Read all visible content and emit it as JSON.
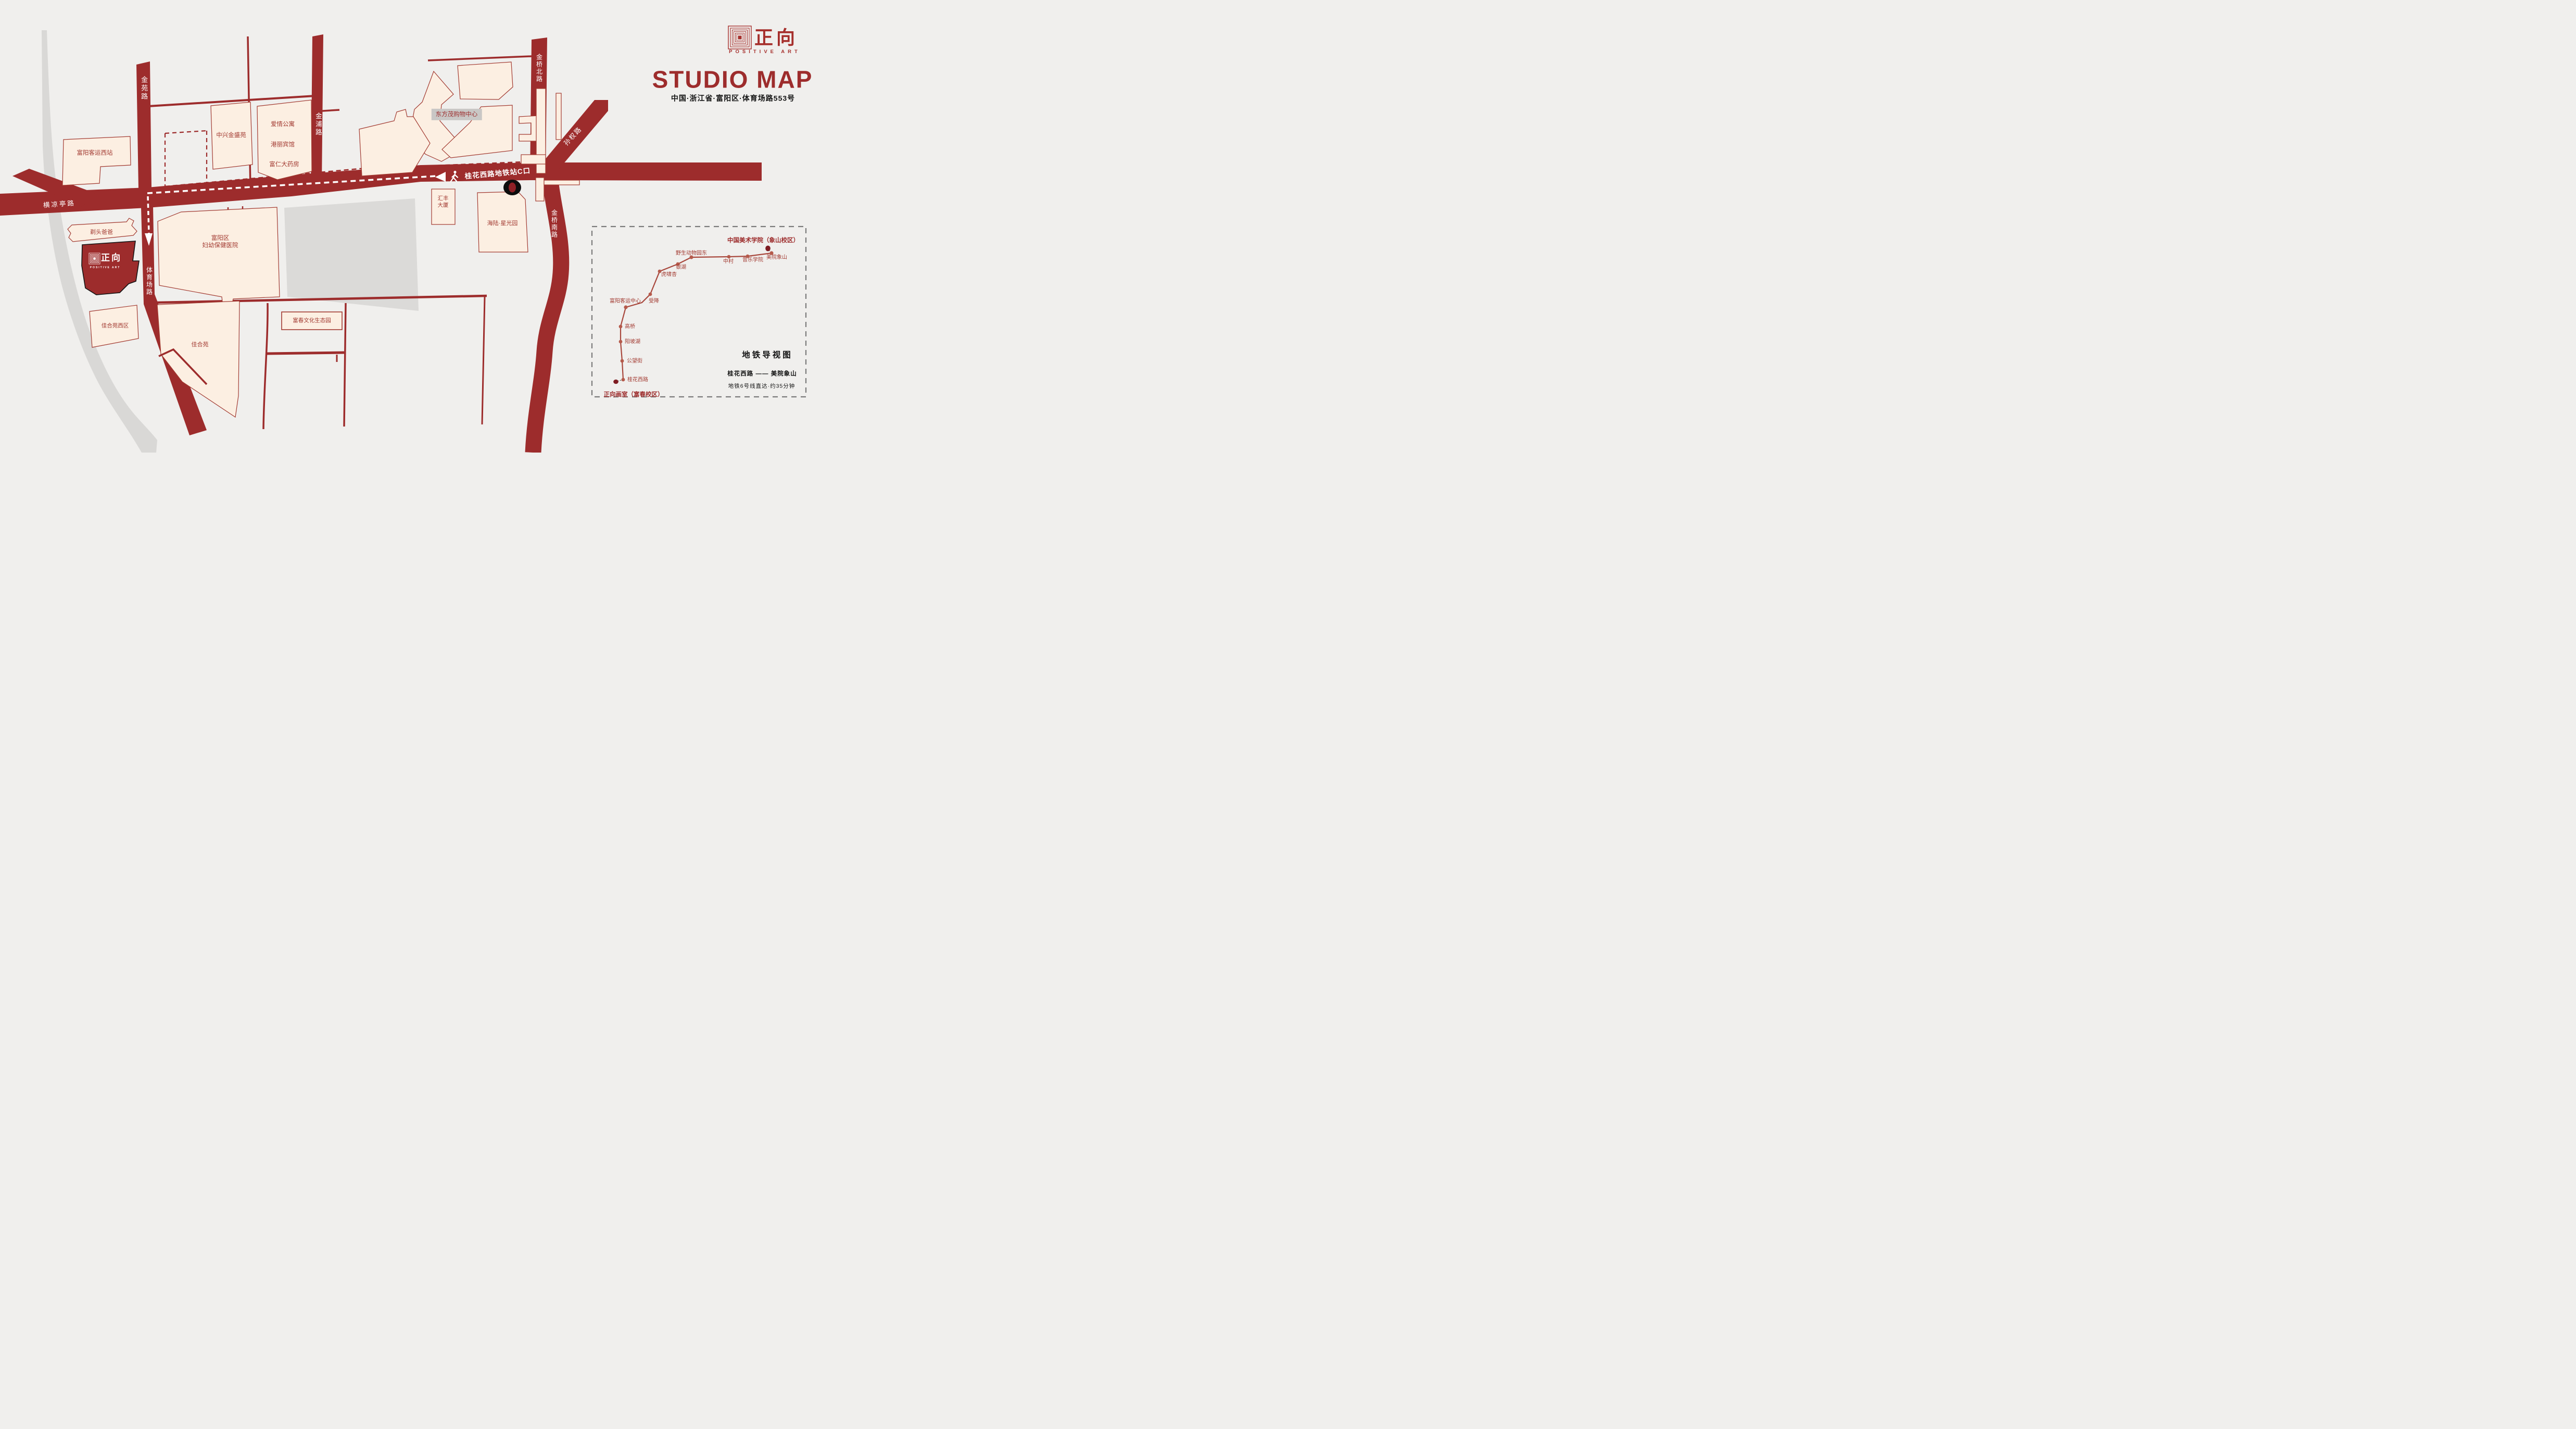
{
  "header": {
    "brand_cn": "正向",
    "brand_en": "POSITIVE ART",
    "title": "STUDIO MAP",
    "address": "中国·浙江省·富阳区·体育场路553号"
  },
  "map": {
    "roads": {
      "jinyuan": "金苑路",
      "jinpu": "金浦路",
      "jinqiao_north": "金桥北路",
      "sunquan": "孙权路",
      "hengliangting": "横凉亭路",
      "tiyuchang": "体育场路",
      "jinqiao_south": "金桥南路"
    },
    "route": {
      "station_exit_label": "桂花西路地铁站C口"
    },
    "buildings": {
      "fuyang_west_bus_station": "富阳客运西站",
      "zhongxing_jinsheng": "中兴金盛苑",
      "aiqing_apartment": "爱情公寓",
      "gangli_hotel": "港丽宾馆",
      "furen_pharmacy": "富仁大药房",
      "dongfangmao_mall": "东方茂购物中心",
      "huifeng_tower_line1": "汇丰",
      "huifeng_tower_line2": "大厦",
      "hailu_starlight": "海陆·星光园",
      "hospital_line1": "富阳区",
      "hospital_line2": "妇幼保健医院",
      "titou_baba": "剃头爸爸",
      "jiaheyuan_west": "佳合苑西区",
      "jiaheyuan": "佳合苑",
      "fuchun_eco_park": "富春文化生态园"
    },
    "studio": {
      "brand_cn": "正向",
      "brand_en": "POSITIVE ART"
    }
  },
  "metro": {
    "panel_title": "地铁导视图",
    "destination_label": "中国美术学院（象山校区）",
    "origin_label": "正向画室（富春校区）",
    "route_summary": "桂花西路 —— 美院象山",
    "duration": "地铁6号线直达·约35分钟",
    "stations": [
      {
        "name": "桂花西路"
      },
      {
        "name": "公望街"
      },
      {
        "name": "阳坡湖"
      },
      {
        "name": "高桥"
      },
      {
        "name": "富阳客运中心"
      },
      {
        "name": "受降"
      },
      {
        "name": "虎啸杏"
      },
      {
        "name": "银湖"
      },
      {
        "name": "野生动物园东"
      },
      {
        "name": "中村"
      },
      {
        "name": "音乐学院"
      },
      {
        "name": "美院象山"
      }
    ]
  },
  "colors": {
    "road": "#9d2c2c",
    "building_fill": "#fcefe2",
    "building_stroke": "#a23a31",
    "background": "#f0efed",
    "gray_band": "#d9d8d6",
    "brand_red": "#a62f2c",
    "marker_black": "#0d0d0d"
  }
}
